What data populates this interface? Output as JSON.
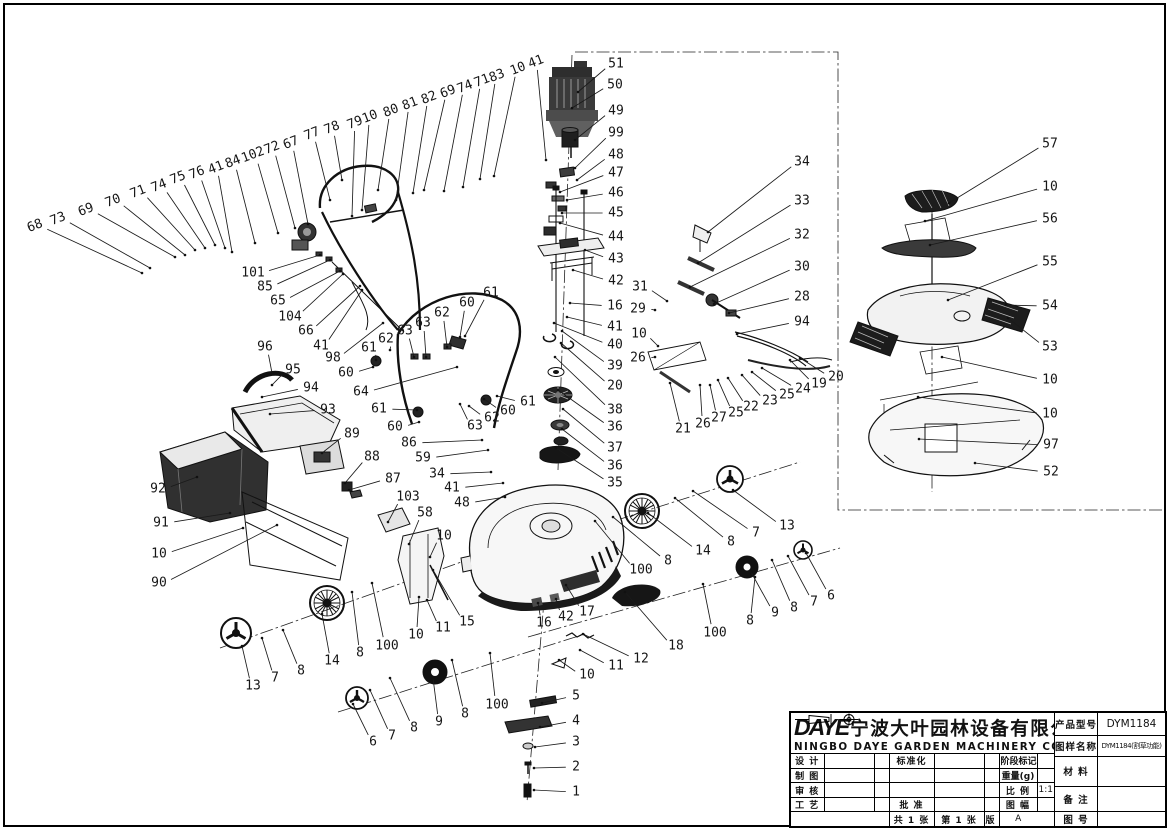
{
  "title_block": {
    "logo": "DAYE",
    "company_cn": "宁波大叶园林设备有限公司",
    "company_en": "NINGBO DAYE GARDEN MACHINERY CO.,LTD.",
    "product_model_label": "产品型号",
    "product_model": "DYM1184",
    "drawing_name_label": "图样名称",
    "drawing_name": "DYM1184(割草功能)",
    "material_label": "材  料",
    "remark_label": "备  注",
    "drawing_no_label": "图  号",
    "design_label": "设 计",
    "draft_label": "制 图",
    "check_label": "审 核",
    "process_label": "工 艺",
    "standardization_label": "标准化",
    "approve_label": "批 准",
    "stage_mark_label": "阶段标记",
    "weight_label": "重量(g)",
    "scale_label": "比 例",
    "scale_value": "1:1",
    "format_label": "图 幅",
    "version_label": "版 本",
    "version_value": "A",
    "sheets_total": "共 1 张",
    "sheet_no": "第 1 张"
  },
  "parts": [
    {
      "n": "68",
      "x": 35,
      "y": 226,
      "tx": 142,
      "ty": 273,
      "rot": 1
    },
    {
      "n": "73",
      "x": 58,
      "y": 219,
      "tx": 150,
      "ty": 268,
      "rot": 1
    },
    {
      "n": "69",
      "x": 86,
      "y": 210,
      "tx": 175,
      "ty": 257,
      "rot": 1
    },
    {
      "n": "70",
      "x": 113,
      "y": 201,
      "tx": 185,
      "ty": 255,
      "rot": 1
    },
    {
      "n": "71",
      "x": 138,
      "y": 192,
      "tx": 195,
      "ty": 250,
      "rot": 1
    },
    {
      "n": "74",
      "x": 159,
      "y": 186,
      "tx": 205,
      "ty": 248,
      "rot": 1
    },
    {
      "n": "75",
      "x": 178,
      "y": 178,
      "tx": 215,
      "ty": 245,
      "rot": 1
    },
    {
      "n": "76",
      "x": 197,
      "y": 173,
      "tx": 225,
      "ty": 248,
      "rot": 1
    },
    {
      "n": "41",
      "x": 216,
      "y": 168,
      "tx": 232,
      "ty": 252,
      "rot": 1
    },
    {
      "n": "84",
      "x": 233,
      "y": 162,
      "tx": 255,
      "ty": 243,
      "rot": 1
    },
    {
      "n": "102",
      "x": 253,
      "y": 155,
      "tx": 278,
      "ty": 233,
      "rot": 1
    },
    {
      "n": "72",
      "x": 272,
      "y": 148,
      "tx": 295,
      "ty": 228,
      "rot": 1
    },
    {
      "n": "67",
      "x": 291,
      "y": 143,
      "tx": 308,
      "ty": 224,
      "rot": 1
    },
    {
      "n": "77",
      "x": 312,
      "y": 134,
      "tx": 330,
      "ty": 200,
      "rot": 1
    },
    {
      "n": "78",
      "x": 332,
      "y": 128,
      "tx": 342,
      "ty": 180,
      "rot": 1
    },
    {
      "n": "79",
      "x": 355,
      "y": 123,
      "tx": 352,
      "ty": 216,
      "rot": 1
    },
    {
      "n": "10",
      "x": 370,
      "y": 117,
      "tx": 362,
      "ty": 210,
      "rot": 1
    },
    {
      "n": "80",
      "x": 391,
      "y": 111,
      "tx": 378,
      "ty": 190,
      "rot": 1
    },
    {
      "n": "81",
      "x": 410,
      "y": 104,
      "tx": 396,
      "ty": 200,
      "rot": 1
    },
    {
      "n": "82",
      "x": 429,
      "y": 98,
      "tx": 413,
      "ty": 193,
      "rot": 1
    },
    {
      "n": "69",
      "x": 448,
      "y": 92,
      "tx": 424,
      "ty": 190,
      "rot": 1
    },
    {
      "n": "74",
      "x": 465,
      "y": 87,
      "tx": 444,
      "ty": 191,
      "rot": 1
    },
    {
      "n": "71",
      "x": 482,
      "y": 81,
      "tx": 463,
      "ty": 187,
      "rot": 1
    },
    {
      "n": "83",
      "x": 497,
      "y": 76,
      "tx": 480,
      "ty": 179,
      "rot": 1
    },
    {
      "n": "10",
      "x": 518,
      "y": 69,
      "tx": 494,
      "ty": 176,
      "rot": 1
    },
    {
      "n": "41",
      "x": 536,
      "y": 62,
      "tx": 546,
      "ty": 160,
      "rot": 1
    },
    {
      "n": "51",
      "x": 616,
      "y": 64,
      "tx": 578,
      "ty": 92
    },
    {
      "n": "50",
      "x": 615,
      "y": 85,
      "tx": 572,
      "ty": 108
    },
    {
      "n": "49",
      "x": 616,
      "y": 111,
      "tx": 575,
      "ty": 140
    },
    {
      "n": "99",
      "x": 616,
      "y": 133,
      "tx": 575,
      "ty": 168
    },
    {
      "n": "48",
      "x": 616,
      "y": 155,
      "tx": 577,
      "ty": 180
    },
    {
      "n": "47",
      "x": 616,
      "y": 173,
      "tx": 560,
      "ty": 192
    },
    {
      "n": "46",
      "x": 616,
      "y": 193,
      "tx": 567,
      "ty": 200
    },
    {
      "n": "45",
      "x": 616,
      "y": 213,
      "tx": 562,
      "ty": 213
    },
    {
      "n": "44",
      "x": 616,
      "y": 237,
      "tx": 560,
      "ty": 223
    },
    {
      "n": "43",
      "x": 616,
      "y": 259,
      "tx": 585,
      "ty": 250
    },
    {
      "n": "42",
      "x": 616,
      "y": 281,
      "tx": 573,
      "ty": 270
    },
    {
      "n": "16",
      "x": 615,
      "y": 306,
      "tx": 570,
      "ty": 303
    },
    {
      "n": "41",
      "x": 615,
      "y": 327,
      "tx": 567,
      "ty": 317
    },
    {
      "n": "40",
      "x": 615,
      "y": 345,
      "tx": 554,
      "ty": 323
    },
    {
      "n": "39",
      "x": 615,
      "y": 366,
      "tx": 562,
      "ty": 331
    },
    {
      "n": "20",
      "x": 615,
      "y": 386,
      "tx": 561,
      "ty": 343
    },
    {
      "n": "38",
      "x": 615,
      "y": 410,
      "tx": 555,
      "ty": 357
    },
    {
      "n": "36",
      "x": 615,
      "y": 427,
      "tx": 558,
      "ty": 390
    },
    {
      "n": "37",
      "x": 615,
      "y": 448,
      "tx": 563,
      "ty": 409
    },
    {
      "n": "36",
      "x": 615,
      "y": 466,
      "tx": 562,
      "ty": 429
    },
    {
      "n": "35",
      "x": 615,
      "y": 483,
      "tx": 556,
      "ty": 448
    },
    {
      "n": "34",
      "x": 802,
      "y": 162,
      "tx": 708,
      "ty": 232
    },
    {
      "n": "33",
      "x": 802,
      "y": 201,
      "tx": 698,
      "ty": 263
    },
    {
      "n": "32",
      "x": 802,
      "y": 235,
      "tx": 690,
      "ty": 287
    },
    {
      "n": "30",
      "x": 802,
      "y": 267,
      "tx": 714,
      "ty": 304
    },
    {
      "n": "28",
      "x": 802,
      "y": 297,
      "tx": 729,
      "ty": 313
    },
    {
      "n": "94",
      "x": 802,
      "y": 322,
      "tx": 737,
      "ty": 334
    },
    {
      "n": "31",
      "x": 640,
      "y": 287,
      "tx": 667,
      "ty": 301
    },
    {
      "n": "29",
      "x": 638,
      "y": 309,
      "tx": 655,
      "ty": 310
    },
    {
      "n": "10",
      "x": 639,
      "y": 334,
      "tx": 658,
      "ty": 346
    },
    {
      "n": "26",
      "x": 638,
      "y": 358,
      "tx": 655,
      "ty": 357
    },
    {
      "n": "21",
      "x": 683,
      "y": 429,
      "tx": 670,
      "ty": 383
    },
    {
      "n": "26",
      "x": 703,
      "y": 424,
      "tx": 700,
      "ty": 385
    },
    {
      "n": "27",
      "x": 719,
      "y": 418,
      "tx": 710,
      "ty": 385
    },
    {
      "n": "25",
      "x": 736,
      "y": 413,
      "tx": 718,
      "ty": 380
    },
    {
      "n": "22",
      "x": 751,
      "y": 407,
      "tx": 728,
      "ty": 378
    },
    {
      "n": "23",
      "x": 770,
      "y": 401,
      "tx": 742,
      "ty": 375
    },
    {
      "n": "25",
      "x": 787,
      "y": 395,
      "tx": 752,
      "ty": 372
    },
    {
      "n": "24",
      "x": 803,
      "y": 389,
      "tx": 762,
      "ty": 368
    },
    {
      "n": "19",
      "x": 819,
      "y": 384,
      "tx": 790,
      "ty": 360
    },
    {
      "n": "20",
      "x": 836,
      "y": 377,
      "tx": 800,
      "ty": 358
    },
    {
      "n": "57",
      "x": 1050,
      "y": 144,
      "tx": 949,
      "ty": 203
    },
    {
      "n": "10",
      "x": 1050,
      "y": 187,
      "tx": 925,
      "ty": 221
    },
    {
      "n": "56",
      "x": 1050,
      "y": 219,
      "tx": 930,
      "ty": 245
    },
    {
      "n": "55",
      "x": 1050,
      "y": 262,
      "tx": 948,
      "ty": 300
    },
    {
      "n": "54",
      "x": 1050,
      "y": 306,
      "tx": 1006,
      "ty": 305
    },
    {
      "n": "53",
      "x": 1050,
      "y": 347,
      "tx": 1008,
      "ty": 318
    },
    {
      "n": "10",
      "x": 1050,
      "y": 380,
      "tx": 942,
      "ty": 357
    },
    {
      "n": "10",
      "x": 1050,
      "y": 414,
      "tx": 918,
      "ty": 397
    },
    {
      "n": "97",
      "x": 1051,
      "y": 445,
      "tx": 919,
      "ty": 439
    },
    {
      "n": "52",
      "x": 1051,
      "y": 472,
      "tx": 975,
      "ty": 463
    },
    {
      "n": "101",
      "x": 253,
      "y": 273,
      "tx": 320,
      "ty": 255
    },
    {
      "n": "85",
      "x": 265,
      "y": 287,
      "tx": 330,
      "ty": 260
    },
    {
      "n": "65",
      "x": 278,
      "y": 301,
      "tx": 340,
      "ty": 271
    },
    {
      "n": "104",
      "x": 290,
      "y": 317,
      "tx": 343,
      "ty": 274
    },
    {
      "n": "66",
      "x": 306,
      "y": 331,
      "tx": 360,
      "ty": 286
    },
    {
      "n": "41",
      "x": 321,
      "y": 346,
      "tx": 362,
      "ty": 290
    },
    {
      "n": "98",
      "x": 333,
      "y": 358,
      "tx": 383,
      "ty": 323
    },
    {
      "n": "96",
      "x": 265,
      "y": 347,
      "tx": 272,
      "ty": 373
    },
    {
      "n": "95",
      "x": 293,
      "y": 370,
      "tx": 272,
      "ty": 385
    },
    {
      "n": "94",
      "x": 311,
      "y": 388,
      "tx": 262,
      "ty": 397
    },
    {
      "n": "93",
      "x": 328,
      "y": 410,
      "tx": 270,
      "ty": 414
    },
    {
      "n": "89",
      "x": 352,
      "y": 434,
      "tx": 322,
      "ty": 453
    },
    {
      "n": "88",
      "x": 372,
      "y": 457,
      "tx": 345,
      "ty": 483
    },
    {
      "n": "87",
      "x": 393,
      "y": 479,
      "tx": 349,
      "ty": 490
    },
    {
      "n": "103",
      "x": 408,
      "y": 497,
      "tx": 388,
      "ty": 522
    },
    {
      "n": "58",
      "x": 425,
      "y": 513,
      "tx": 409,
      "ty": 544
    },
    {
      "n": "10",
      "x": 444,
      "y": 536,
      "tx": 430,
      "ty": 557
    },
    {
      "n": "61",
      "x": 369,
      "y": 348,
      "tx": 376,
      "ty": 360
    },
    {
      "n": "60",
      "x": 346,
      "y": 373,
      "tx": 373,
      "ty": 367
    },
    {
      "n": "62",
      "x": 386,
      "y": 339,
      "tx": 390,
      "ty": 350
    },
    {
      "n": "63",
      "x": 405,
      "y": 331,
      "tx": 414,
      "ty": 357
    },
    {
      "n": "63",
      "x": 423,
      "y": 323,
      "tx": 426,
      "ty": 357
    },
    {
      "n": "62",
      "x": 442,
      "y": 313,
      "tx": 447,
      "ty": 347
    },
    {
      "n": "60",
      "x": 467,
      "y": 303,
      "tx": 460,
      "ty": 337
    },
    {
      "n": "61",
      "x": 491,
      "y": 293,
      "tx": 465,
      "ty": 336
    },
    {
      "n": "64",
      "x": 361,
      "y": 392,
      "tx": 457,
      "ty": 367
    },
    {
      "n": "61",
      "x": 379,
      "y": 409,
      "tx": 417,
      "ty": 410
    },
    {
      "n": "60",
      "x": 395,
      "y": 427,
      "tx": 419,
      "ty": 422
    },
    {
      "n": "63",
      "x": 475,
      "y": 426,
      "tx": 460,
      "ty": 404
    },
    {
      "n": "62",
      "x": 492,
      "y": 418,
      "tx": 469,
      "ty": 406
    },
    {
      "n": "60",
      "x": 508,
      "y": 411,
      "tx": 484,
      "ty": 399
    },
    {
      "n": "61",
      "x": 528,
      "y": 402,
      "tx": 497,
      "ty": 396
    },
    {
      "n": "86",
      "x": 409,
      "y": 443,
      "tx": 482,
      "ty": 440
    },
    {
      "n": "59",
      "x": 423,
      "y": 458,
      "tx": 488,
      "ty": 450
    },
    {
      "n": "34",
      "x": 437,
      "y": 474,
      "tx": 491,
      "ty": 472
    },
    {
      "n": "41",
      "x": 452,
      "y": 488,
      "tx": 503,
      "ty": 483
    },
    {
      "n": "48",
      "x": 462,
      "y": 503,
      "tx": 505,
      "ty": 497
    },
    {
      "n": "92",
      "x": 158,
      "y": 489,
      "tx": 197,
      "ty": 477
    },
    {
      "n": "91",
      "x": 161,
      "y": 523,
      "tx": 230,
      "ty": 513
    },
    {
      "n": "10",
      "x": 159,
      "y": 554,
      "tx": 243,
      "ty": 528
    },
    {
      "n": "90",
      "x": 159,
      "y": 583,
      "tx": 277,
      "ty": 525
    },
    {
      "n": "13",
      "x": 253,
      "y": 686,
      "tx": 242,
      "ty": 646
    },
    {
      "n": "7",
      "x": 275,
      "y": 678,
      "tx": 262,
      "ty": 638
    },
    {
      "n": "8",
      "x": 301,
      "y": 671,
      "tx": 283,
      "ty": 630
    },
    {
      "n": "14",
      "x": 332,
      "y": 661,
      "tx": 322,
      "ty": 614
    },
    {
      "n": "8",
      "x": 360,
      "y": 653,
      "tx": 352,
      "ty": 592
    },
    {
      "n": "100",
      "x": 387,
      "y": 646,
      "tx": 372,
      "ty": 583
    },
    {
      "n": "10",
      "x": 416,
      "y": 635,
      "tx": 419,
      "ty": 597
    },
    {
      "n": "11",
      "x": 443,
      "y": 628,
      "tx": 427,
      "ty": 600
    },
    {
      "n": "15",
      "x": 467,
      "y": 622,
      "tx": 433,
      "ty": 570
    },
    {
      "n": "6",
      "x": 373,
      "y": 742,
      "tx": 353,
      "ty": 704
    },
    {
      "n": "7",
      "x": 392,
      "y": 736,
      "tx": 370,
      "ty": 690
    },
    {
      "n": "8",
      "x": 414,
      "y": 728,
      "tx": 390,
      "ty": 678
    },
    {
      "n": "9",
      "x": 439,
      "y": 722,
      "tx": 433,
      "ty": 678
    },
    {
      "n": "8",
      "x": 465,
      "y": 714,
      "tx": 452,
      "ty": 660
    },
    {
      "n": "100",
      "x": 497,
      "y": 705,
      "tx": 490,
      "ty": 653
    },
    {
      "n": "5",
      "x": 576,
      "y": 696,
      "tx": 542,
      "ty": 703
    },
    {
      "n": "4",
      "x": 576,
      "y": 721,
      "tx": 540,
      "ty": 727
    },
    {
      "n": "3",
      "x": 576,
      "y": 742,
      "tx": 535,
      "ty": 747
    },
    {
      "n": "2",
      "x": 576,
      "y": 767,
      "tx": 534,
      "ty": 768
    },
    {
      "n": "1",
      "x": 576,
      "y": 792,
      "tx": 534,
      "ty": 790
    },
    {
      "n": "16",
      "x": 544,
      "y": 623,
      "tx": 538,
      "ty": 603
    },
    {
      "n": "42",
      "x": 566,
      "y": 617,
      "tx": 556,
      "ty": 599
    },
    {
      "n": "17",
      "x": 587,
      "y": 612,
      "tx": 566,
      "ty": 585
    },
    {
      "n": "12",
      "x": 641,
      "y": 659,
      "tx": 583,
      "ty": 634
    },
    {
      "n": "11",
      "x": 616,
      "y": 666,
      "tx": 580,
      "ty": 650
    },
    {
      "n": "10",
      "x": 587,
      "y": 675,
      "tx": 559,
      "ty": 660
    },
    {
      "n": "18",
      "x": 676,
      "y": 646,
      "tx": 625,
      "ty": 592
    },
    {
      "n": "100",
      "x": 715,
      "y": 633,
      "tx": 703,
      "ty": 584
    },
    {
      "n": "13",
      "x": 787,
      "y": 526,
      "tx": 733,
      "ty": 490
    },
    {
      "n": "7",
      "x": 756,
      "y": 533,
      "tx": 693,
      "ty": 491
    },
    {
      "n": "8",
      "x": 731,
      "y": 542,
      "tx": 675,
      "ty": 498
    },
    {
      "n": "14",
      "x": 703,
      "y": 551,
      "tx": 648,
      "ty": 513
    },
    {
      "n": "8",
      "x": 668,
      "y": 561,
      "tx": 613,
      "ty": 517
    },
    {
      "n": "100",
      "x": 641,
      "y": 570,
      "tx": 595,
      "ty": 521
    },
    {
      "n": "6",
      "x": 831,
      "y": 596,
      "tx": 806,
      "ty": 553
    },
    {
      "n": "7",
      "x": 814,
      "y": 602,
      "tx": 788,
      "ty": 556
    },
    {
      "n": "8",
      "x": 794,
      "y": 608,
      "tx": 772,
      "ty": 560
    },
    {
      "n": "9",
      "x": 775,
      "y": 613,
      "tx": 751,
      "ty": 572
    },
    {
      "n": "8",
      "x": 750,
      "y": 621,
      "tx": 755,
      "ty": 577
    }
  ]
}
